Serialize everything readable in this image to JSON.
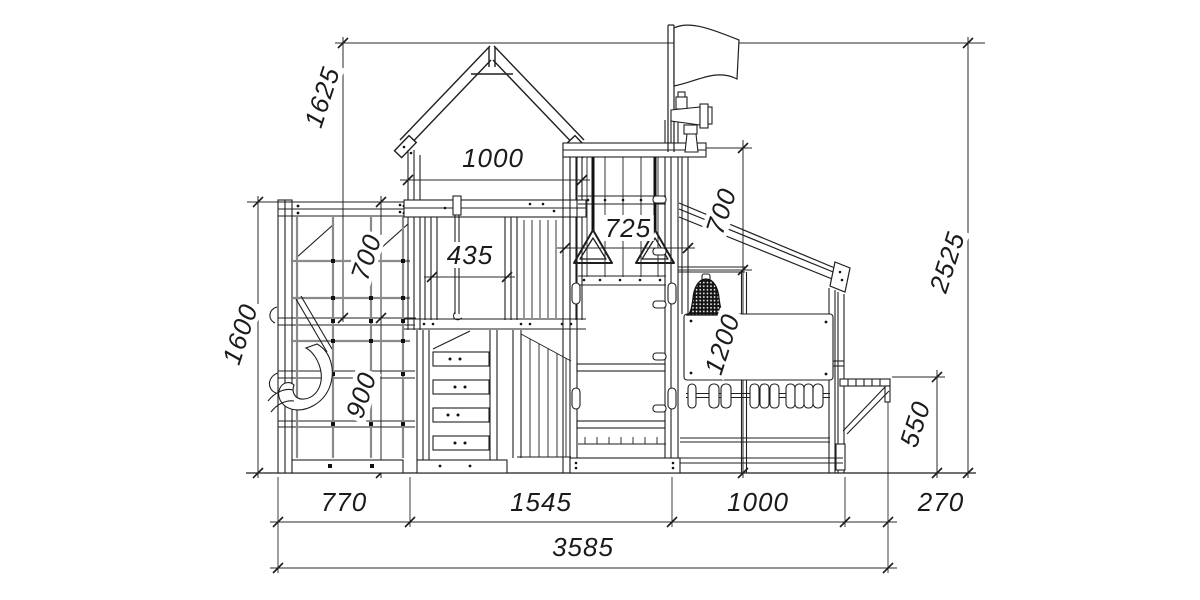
{
  "drawing": {
    "title": "playground-side-elevation",
    "units": "mm",
    "dimensions": {
      "peak_to_platform": "1625",
      "roof_width": "1000",
      "tower_opening": "435",
      "rings_width": "725",
      "rings_drop": "700",
      "overall_height": "2525",
      "left_frame_height": "1600",
      "net_upper": "700",
      "net_lower": "900",
      "panel_height": "1200",
      "bench_height": "550",
      "base_left": "770",
      "base_middle": "1545",
      "base_right": "1000",
      "bench_overhang": "270",
      "overall_width": "3585"
    },
    "components": {
      "flag": "flag-icon",
      "telescope": "telescope-icon",
      "bell": "bell-icon",
      "rings": "gym-rings-icon",
      "swing_seat": "swing-seat-icon",
      "climbing_net": "net-icon",
      "abacus": "counting-beads-icon",
      "bench": "bench-icon"
    },
    "line_color": "#1f1f1f",
    "rope_color": "#8a8a8a"
  }
}
